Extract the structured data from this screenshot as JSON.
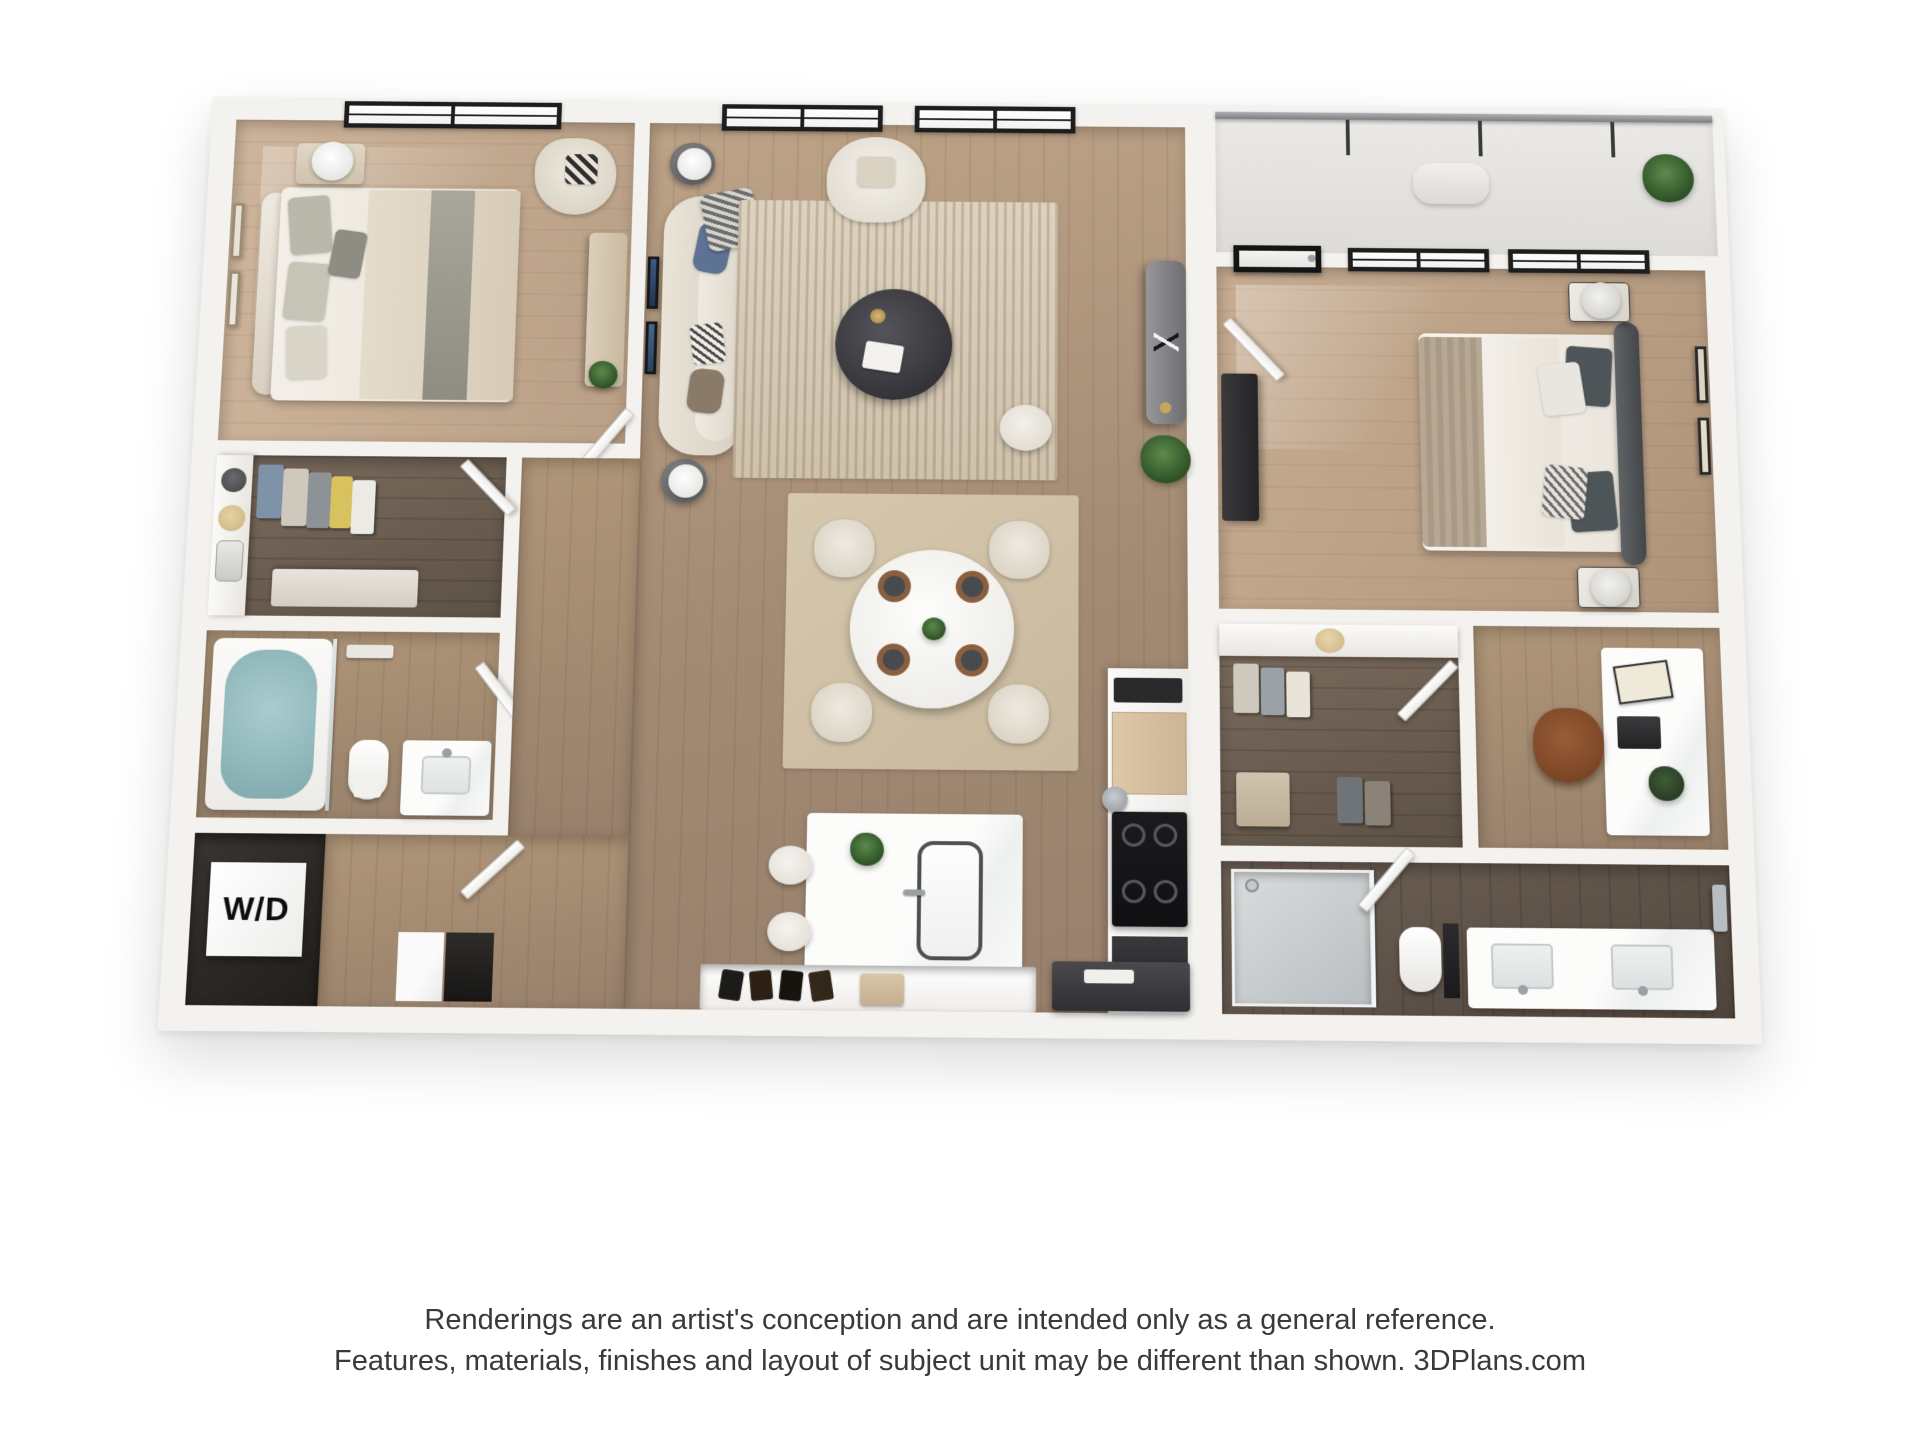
{
  "plan": {
    "wd_label": "W/D"
  },
  "disclaimer": {
    "line1": "Renderings are an artist's conception and are intended only as a general reference.",
    "line2": "Features, materials, finishes and layout of subject unit may be different than shown. 3DPlans.com"
  },
  "palette": {
    "page_background": "#ffffff",
    "wall_white": "#f4f2ef",
    "floor_light_wood": "#c3aa8f",
    "floor_mid_wood": "#a58e77",
    "floor_dark_tile": "#6f6156",
    "window_frame_black": "#1d1d1d",
    "rug_beige": "#d8ccba",
    "sofa_cream": "#e5dfd4",
    "tub_water_teal": "#8fbabd",
    "plant_green": "#35582f",
    "console_gray": "#87878a",
    "entry_charcoal": "#3f3f41",
    "leather_brown": "#8a4f2e",
    "cabinet_tan": "#d9c3a4",
    "text_gray": "#3a3a3a"
  }
}
